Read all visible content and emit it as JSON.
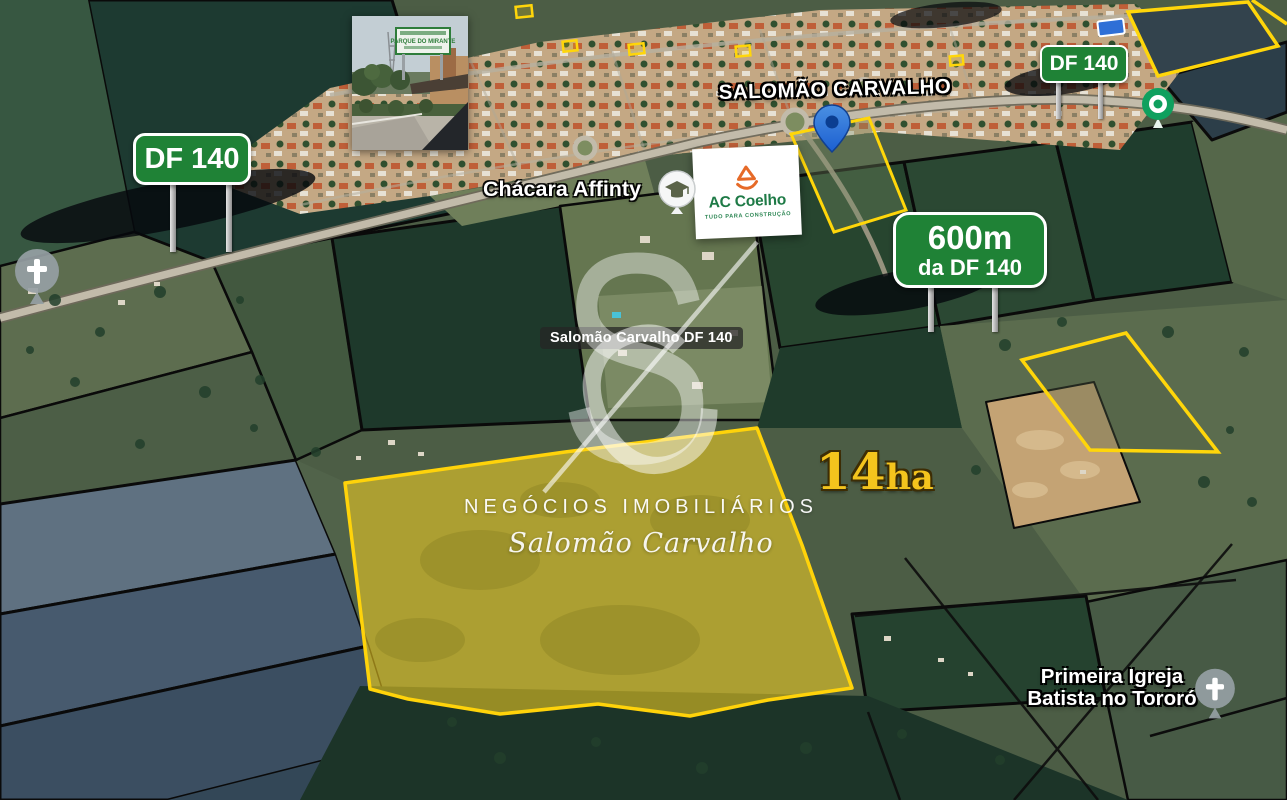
{
  "signs": {
    "df140_left": "DF 140",
    "df140_right": "DF 140",
    "distance_line1": "600m",
    "distance_line2": "da DF 140"
  },
  "labels": {
    "road_name": "SALOMÃO CARVALHO",
    "chacara": "Chácara Affinty",
    "parcel_pill": "Salomão Carvalho DF 140",
    "church_line1": "Primeira Igreja",
    "church_line2": "Batista no Tororó"
  },
  "area_badge": {
    "value": "14",
    "unit": "ha"
  },
  "ac_coelho": {
    "name": "AC Coelho",
    "tagline": "TUDO PARA CONSTRUÇÃO"
  },
  "watermark": {
    "monogram_left": "S",
    "monogram_right": "C",
    "line1": "NEGÓCIOS IMOBILIÁRIOS",
    "line2": "Salomão Carvalho"
  },
  "photo_inset": {
    "sign_text": "PARQUE DO MIRANTE"
  },
  "colors": {
    "sign_green": "#1F8236",
    "highlight_yellow": "#FFD30A",
    "gold_text": "#F4C41D",
    "ac_orange": "#E66A28",
    "ac_green": "#1E7A46",
    "pin_blue": "#2E7BE9",
    "pin_teal": "#0FA05E",
    "slate_parcel": "#475A6E",
    "forest_dark": "#1E392B"
  }
}
